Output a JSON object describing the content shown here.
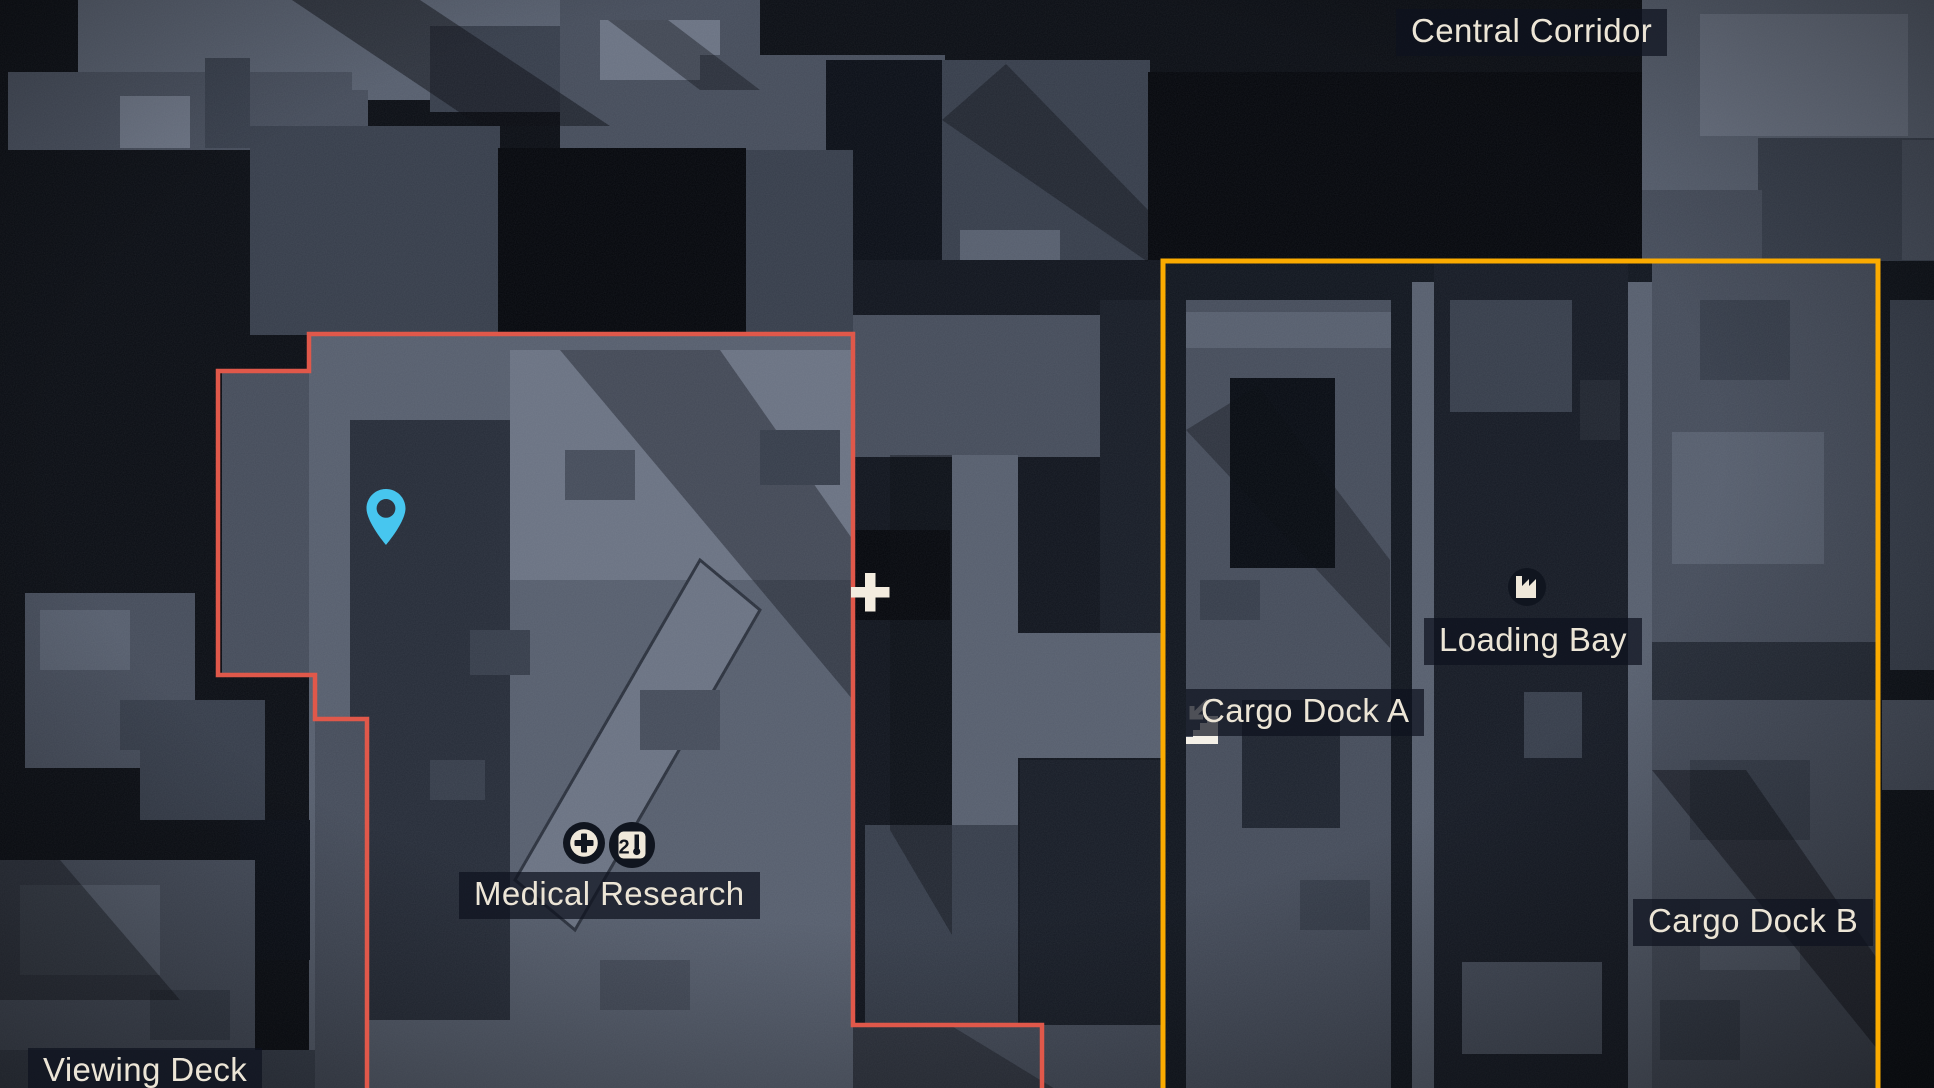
{
  "view": {
    "name": "tactical-map"
  },
  "labels": {
    "central_corridor": "Central Corridor",
    "medical_research": "Medical Research",
    "loading_bay": "Loading Bay",
    "cargo_dock_a": "Cargo Dock A",
    "cargo_dock_b": "Cargo Dock B",
    "viewing_deck": "Viewing Deck"
  },
  "zones": [
    {
      "id": "medical-research-zone",
      "outline": "red"
    },
    {
      "id": "cargo-docks-zone",
      "outline": "yellow"
    }
  ],
  "markers": [
    {
      "id": "player-location",
      "icon": "location-pin-icon"
    },
    {
      "id": "medical-station",
      "icon": "medical-cross-icon"
    },
    {
      "id": "research-terminal",
      "icon": "research-terminal-icon"
    },
    {
      "id": "loading-bay-marker",
      "icon": "factory-icon"
    },
    {
      "id": "stairs-down-marker",
      "icon": "stairs-down-icon"
    },
    {
      "id": "cursor",
      "icon": "crosshair-icon"
    }
  ],
  "glyphs": {
    "research_terminal_digit": "2"
  },
  "colors": {
    "zone_red": "#e0584a",
    "zone_yellow": "#fbab00",
    "pin_cyan": "#47c6ef",
    "crosshair_cream": "#f3ecdf",
    "label_text": "#ece5d6",
    "label_bg": "rgba(14,18,30,0.72)",
    "icon_dark": "#10151f",
    "icon_cream": "#efe8da",
    "stairs_white": "#f5f1e8"
  }
}
